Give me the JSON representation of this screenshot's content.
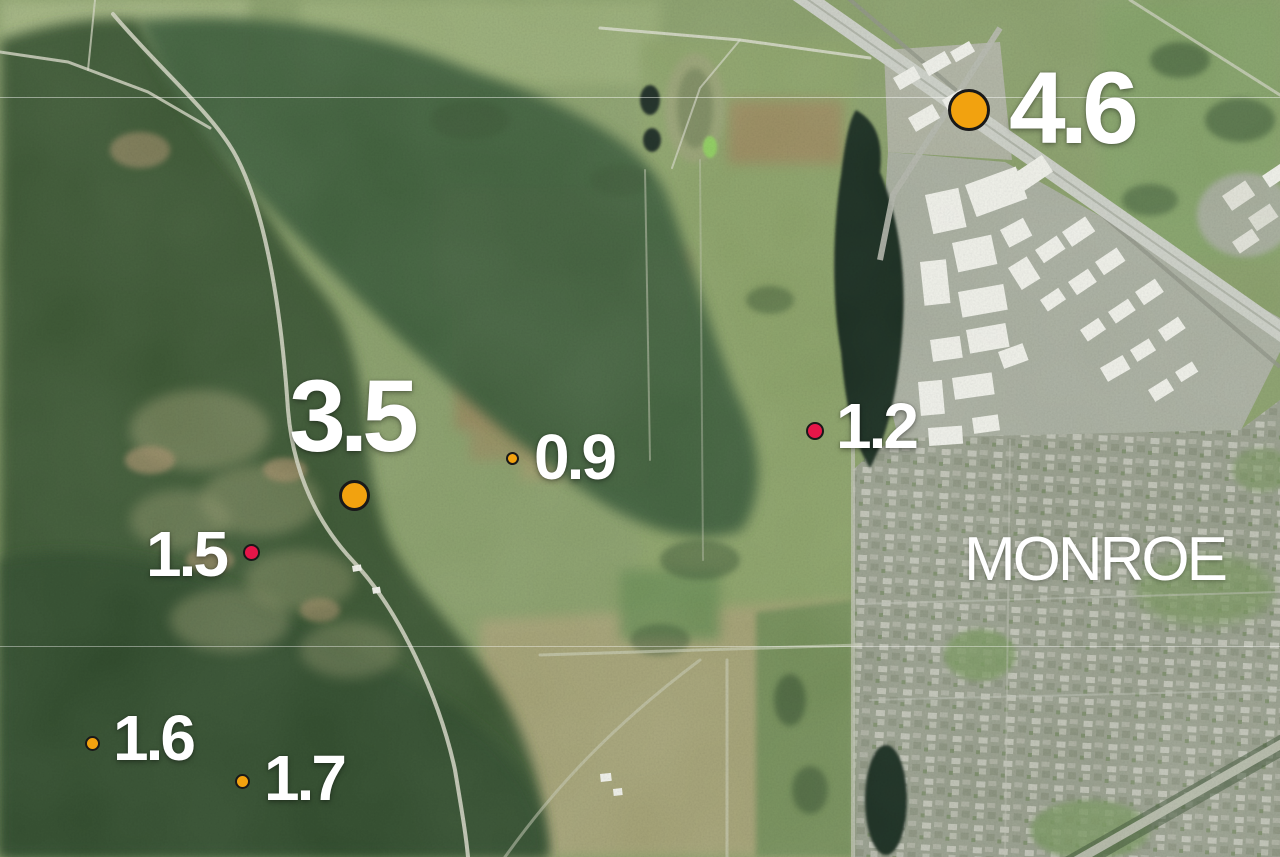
{
  "map": {
    "place_label": "MONROE",
    "palette": {
      "marker_orange": "#F2A20F",
      "marker_red": "#E61649",
      "marker_outline": "#191919",
      "label_white": "#FFFFFF"
    },
    "markers": [
      {
        "magnitude": "4.6",
        "x": 969,
        "y": 110,
        "dot_px": 42,
        "color": "#F2A20F",
        "label_px": 102,
        "align": "left",
        "label_dx": 40,
        "label_dy": 3
      },
      {
        "magnitude": "3.5",
        "x": 354,
        "y": 495,
        "dot_px": 31,
        "color": "#F2A20F",
        "label_px": 102,
        "align": "center",
        "label_dx": -3,
        "label_dy": -74
      },
      {
        "magnitude": "0.9",
        "x": 512,
        "y": 458,
        "dot_px": 13,
        "color": "#F2A20F",
        "label_px": 64,
        "align": "left",
        "label_dx": 22,
        "label_dy": 2
      },
      {
        "magnitude": "1.2",
        "x": 815,
        "y": 431,
        "dot_px": 18,
        "color": "#E61649",
        "label_px": 64,
        "align": "left",
        "label_dx": 21,
        "label_dy": -2
      },
      {
        "magnitude": "1.5",
        "x": 251,
        "y": 552,
        "dot_px": 17,
        "color": "#E61649",
        "label_px": 64,
        "align": "right",
        "label_dx": -25,
        "label_dy": 5
      },
      {
        "magnitude": "1.6",
        "x": 92,
        "y": 743,
        "dot_px": 15,
        "color": "#F2A20F",
        "label_px": 64,
        "align": "left",
        "label_dx": 21,
        "label_dy": -2
      },
      {
        "magnitude": "1.7",
        "x": 242,
        "y": 781,
        "dot_px": 15,
        "color": "#F2A20F",
        "label_px": 64,
        "align": "left",
        "label_dx": 22,
        "label_dy": 0
      }
    ]
  }
}
